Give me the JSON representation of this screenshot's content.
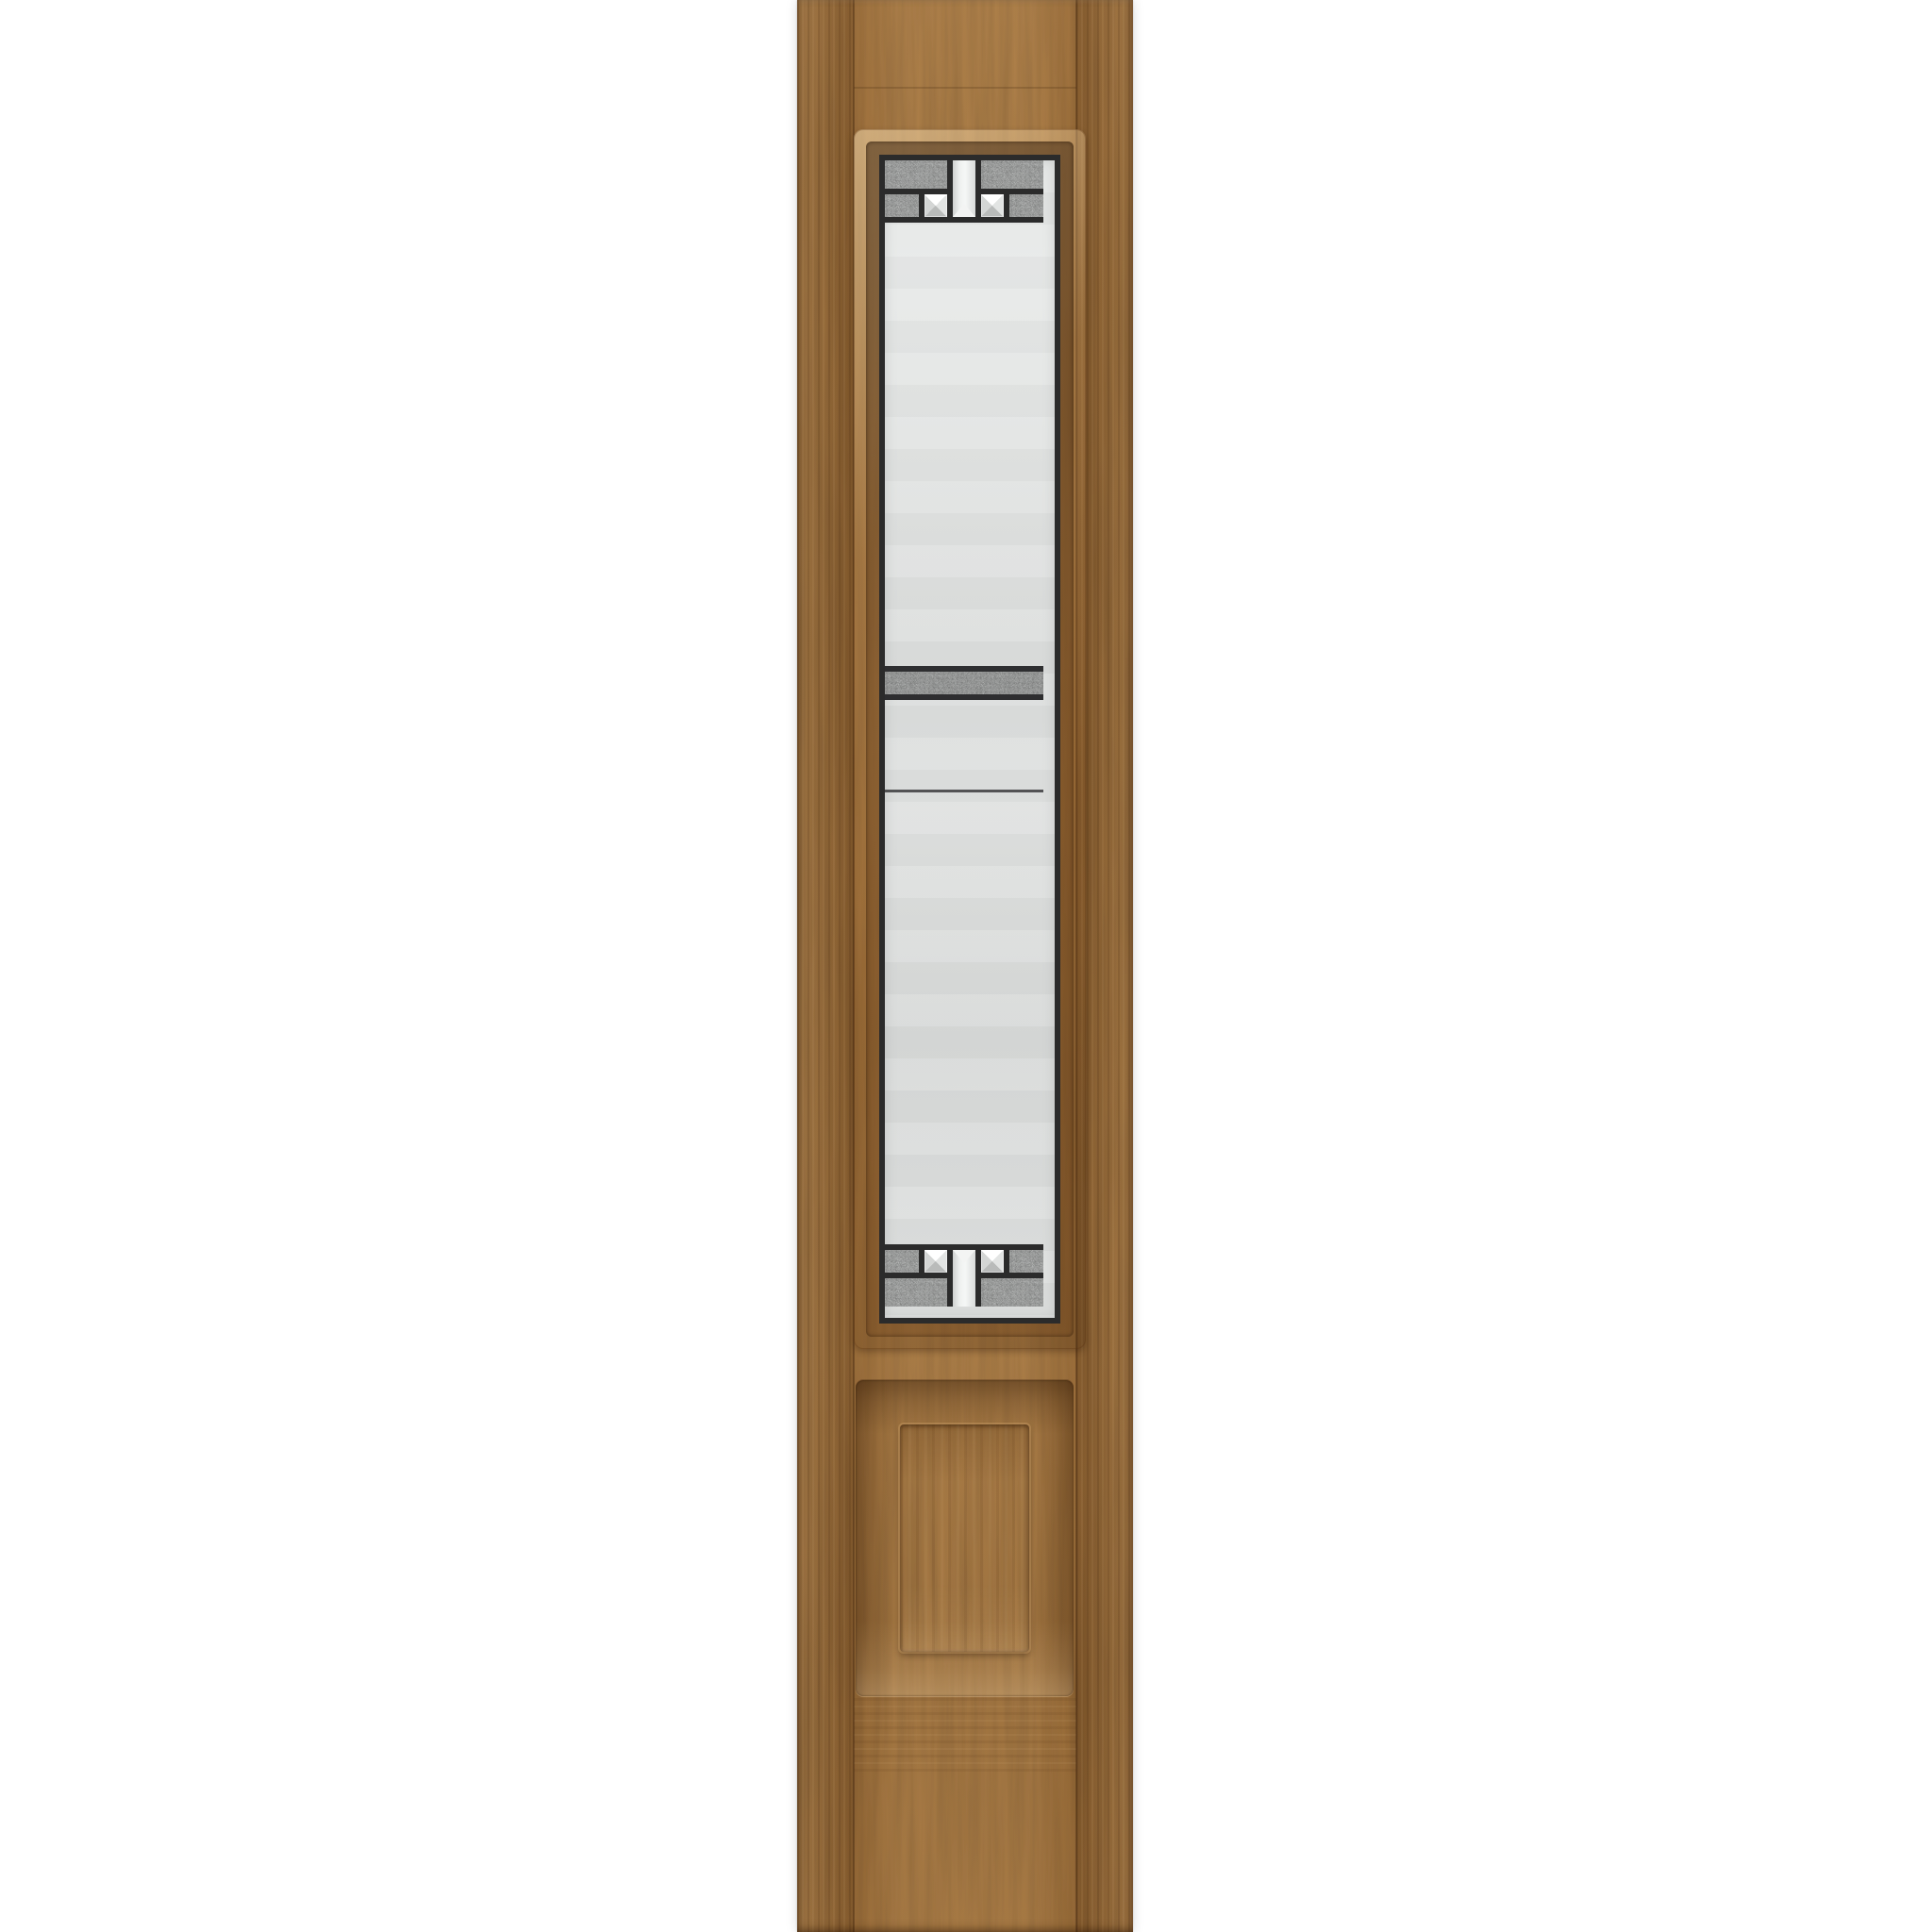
{
  "meta": {
    "type": "product-photo",
    "subject": "Oak woodgrain door sidelight with decorative leaded glass and raised bottom panel",
    "background_color": "#ffffff"
  },
  "door": {
    "label": "sidelight-slab",
    "finish": "medium oak woodgrain",
    "stile_count": 2,
    "palette": {
      "wood_base": "#a3743d",
      "wood_highlight": "#c79b5e",
      "wood_shadow": "#5e3a13",
      "edge_shadow": "#2d1604"
    }
  },
  "glass_panel": {
    "label": "decorative-art-glass",
    "caming_color": "#2b2b2b",
    "clear_glass_color": "#e0e2e1",
    "textured_glass_color": "#d0d2d1",
    "granite_band_color": "#c8cac9",
    "bevel_glass_color": "#ffffff",
    "top_band": {
      "rows": 2,
      "textured_blocks": 4,
      "bevel_squares": 2,
      "center_bevel_columns": 1
    },
    "middle_section": {
      "granite_texture_bands": 1,
      "thin_caming_lines": 1
    },
    "bottom_band": {
      "rows": 2,
      "textured_blocks": 4,
      "bevel_squares": 2,
      "center_bevel_columns": 1
    }
  },
  "raised_panel": {
    "label": "raised-square-panel",
    "style": "beveled recess with raised center field"
  }
}
